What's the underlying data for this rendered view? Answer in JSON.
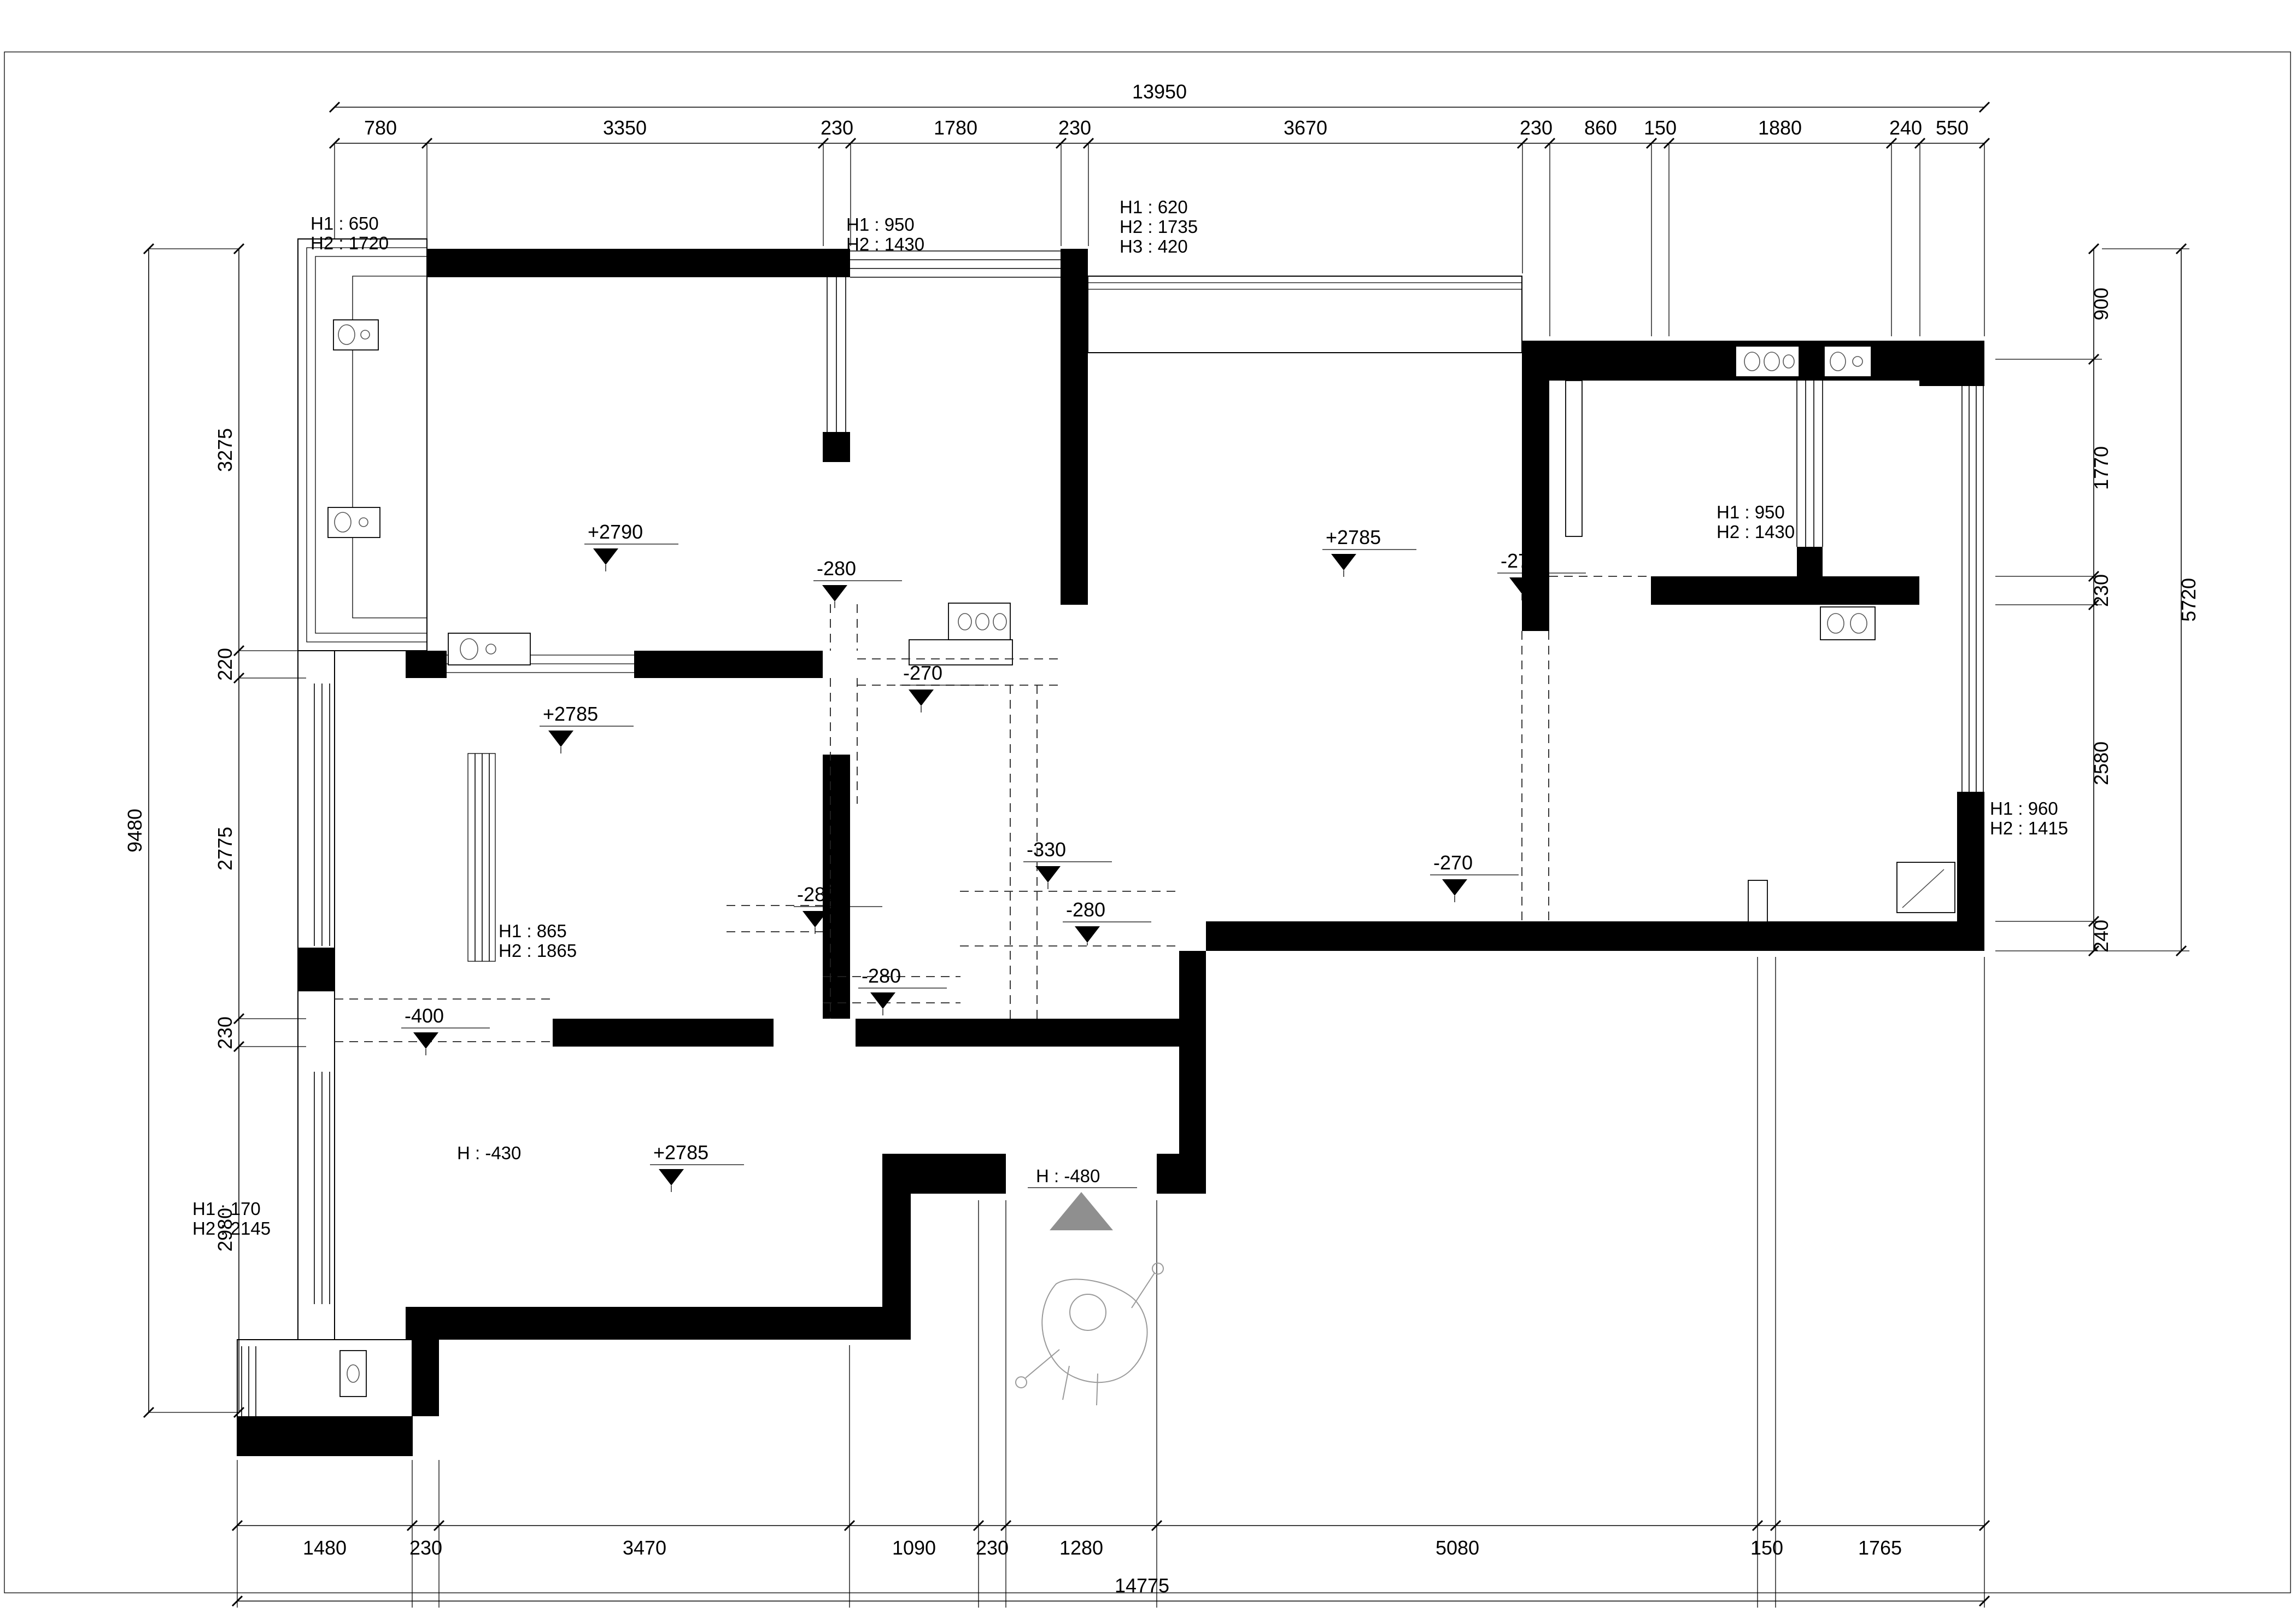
{
  "dimensions": {
    "top": {
      "total": "13950",
      "segments": [
        "780",
        "3350",
        "230",
        "1780",
        "230",
        "3670",
        "230",
        "860",
        "150",
        "1880",
        "240",
        "550"
      ]
    },
    "left": {
      "total": "9480",
      "segments": [
        "3275",
        "220",
        "2775",
        "230",
        "2980"
      ]
    },
    "right": {
      "total": "5720",
      "segments": [
        "900",
        "1770",
        "230",
        "2580",
        "240"
      ]
    },
    "bottom": {
      "total": "14775",
      "segments": [
        "1480",
        "230",
        "3470",
        "1090",
        "230",
        "1280",
        "5080",
        "150",
        "1765"
      ]
    }
  },
  "levels": {
    "room_a": "+2790",
    "room_b": "+2785",
    "room_c": "+2785",
    "living": "+2785",
    "m280_hall_top": "-280",
    "m270_hall": "-270",
    "m330_hall": "-330",
    "m280_room_b": "-280",
    "m280_hall_bottom": "-280",
    "m280_vestibule": "-280",
    "m270_kitchen": "-270",
    "m270_right": "-270",
    "m400_left": "-400"
  },
  "height_notes": {
    "bay_tl": [
      "H1 : 650",
      "H2 : 1720"
    ],
    "top_window": [
      "H1 : 950",
      "H2 : 1430"
    ],
    "living_bay": [
      "H1 : 620",
      "H2 : 1735",
      "H3 : 420"
    ],
    "room_b_window": [
      "H1 : 865",
      "H2 : 1865"
    ],
    "room_c_window": [
      "H1 : 170",
      "H2 : 2145"
    ],
    "kitchen_window": [
      "H1 : 950",
      "H2 : 1430"
    ],
    "right_window": [
      "H1 : 960",
      "H2 : 1415"
    ],
    "room_c_door": "H : -430",
    "entrance": "H : -480"
  },
  "colors": {
    "wall": "#000000",
    "entrance_triangle": "#8f8f8f",
    "figure": "#9a9a9a"
  }
}
